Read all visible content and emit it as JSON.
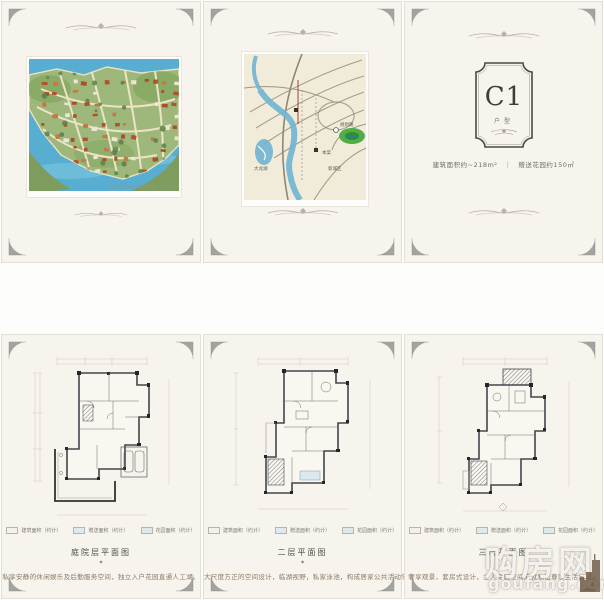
{
  "watermark": {
    "cn": "购房网",
    "domain": "goufang.com"
  },
  "masterplan": {
    "disclaimer": "本图为项目整体鸟瞰效果示意图，仅供参考"
  },
  "map": {
    "labels": {
      "project": "本案",
      "lake": "大龙湖",
      "road": "规划路",
      "district": "新城区"
    }
  },
  "unit_panel": {
    "code": "C1",
    "type_label": "户型",
    "area_info": "建筑面积约~218m²　｜　赠送花园约150㎡"
  },
  "legend": [
    {
      "label": "建筑面积（约计）"
    },
    {
      "label": "赠送面积（约计）"
    },
    {
      "label": "花园面积（约计）"
    }
  ],
  "floors": [
    {
      "caption": "庭院层平面图",
      "marker": "◆",
      "description": "私享安静的休闲娱乐及后勤服务空间，独立入户花园直通人工湖。"
    },
    {
      "caption": "二层平面图",
      "marker": "◆",
      "description": "大尺度方正的空间设计，临湖视野，私家泳池，构成居家公共活动领域。"
    },
    {
      "caption": "三层平面图",
      "marker": "◆",
      "description": "奢享观景，套房式设计，主人专属空间成就私密尊崇生活领域。"
    }
  ],
  "colors": {
    "panel_bg": "#f7f4ee",
    "frame": "#4a4a45",
    "water": "#57aed0",
    "land": "#9db87a",
    "roof": "#b0522e",
    "map_river": "#6fb4d2",
    "map_green": "#4fae46",
    "plan_line": "#42464b"
  }
}
